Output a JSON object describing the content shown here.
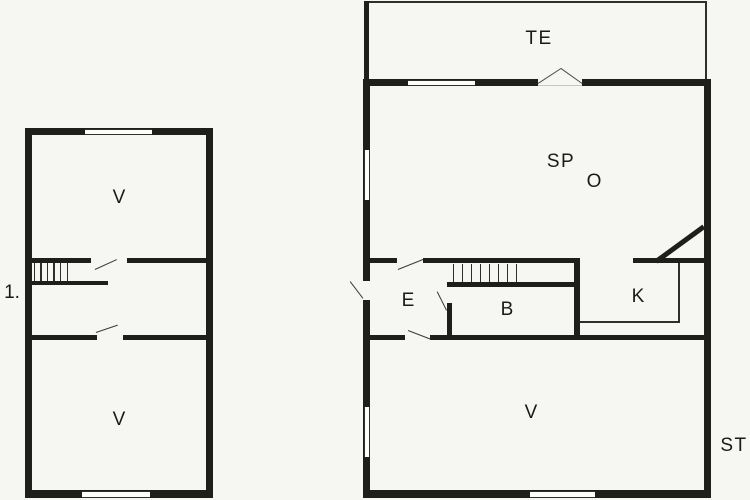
{
  "title": "Holiday house floor plan",
  "colors": {
    "background": "#f6f6f3",
    "wall": "#1e1e1c",
    "line": "#2e2e2c",
    "label": "#1a1a1a"
  },
  "floorplan": {
    "upper_floor": {
      "marker": "1.",
      "room_v_top": "V",
      "room_v_bottom": "V"
    },
    "ground_floor": {
      "terrace": "TE",
      "room_sp": "SP",
      "room_o": "O",
      "entry": "E",
      "bath": "B",
      "kitchen": "K",
      "room_v": "V",
      "exterior": "ST"
    }
  }
}
